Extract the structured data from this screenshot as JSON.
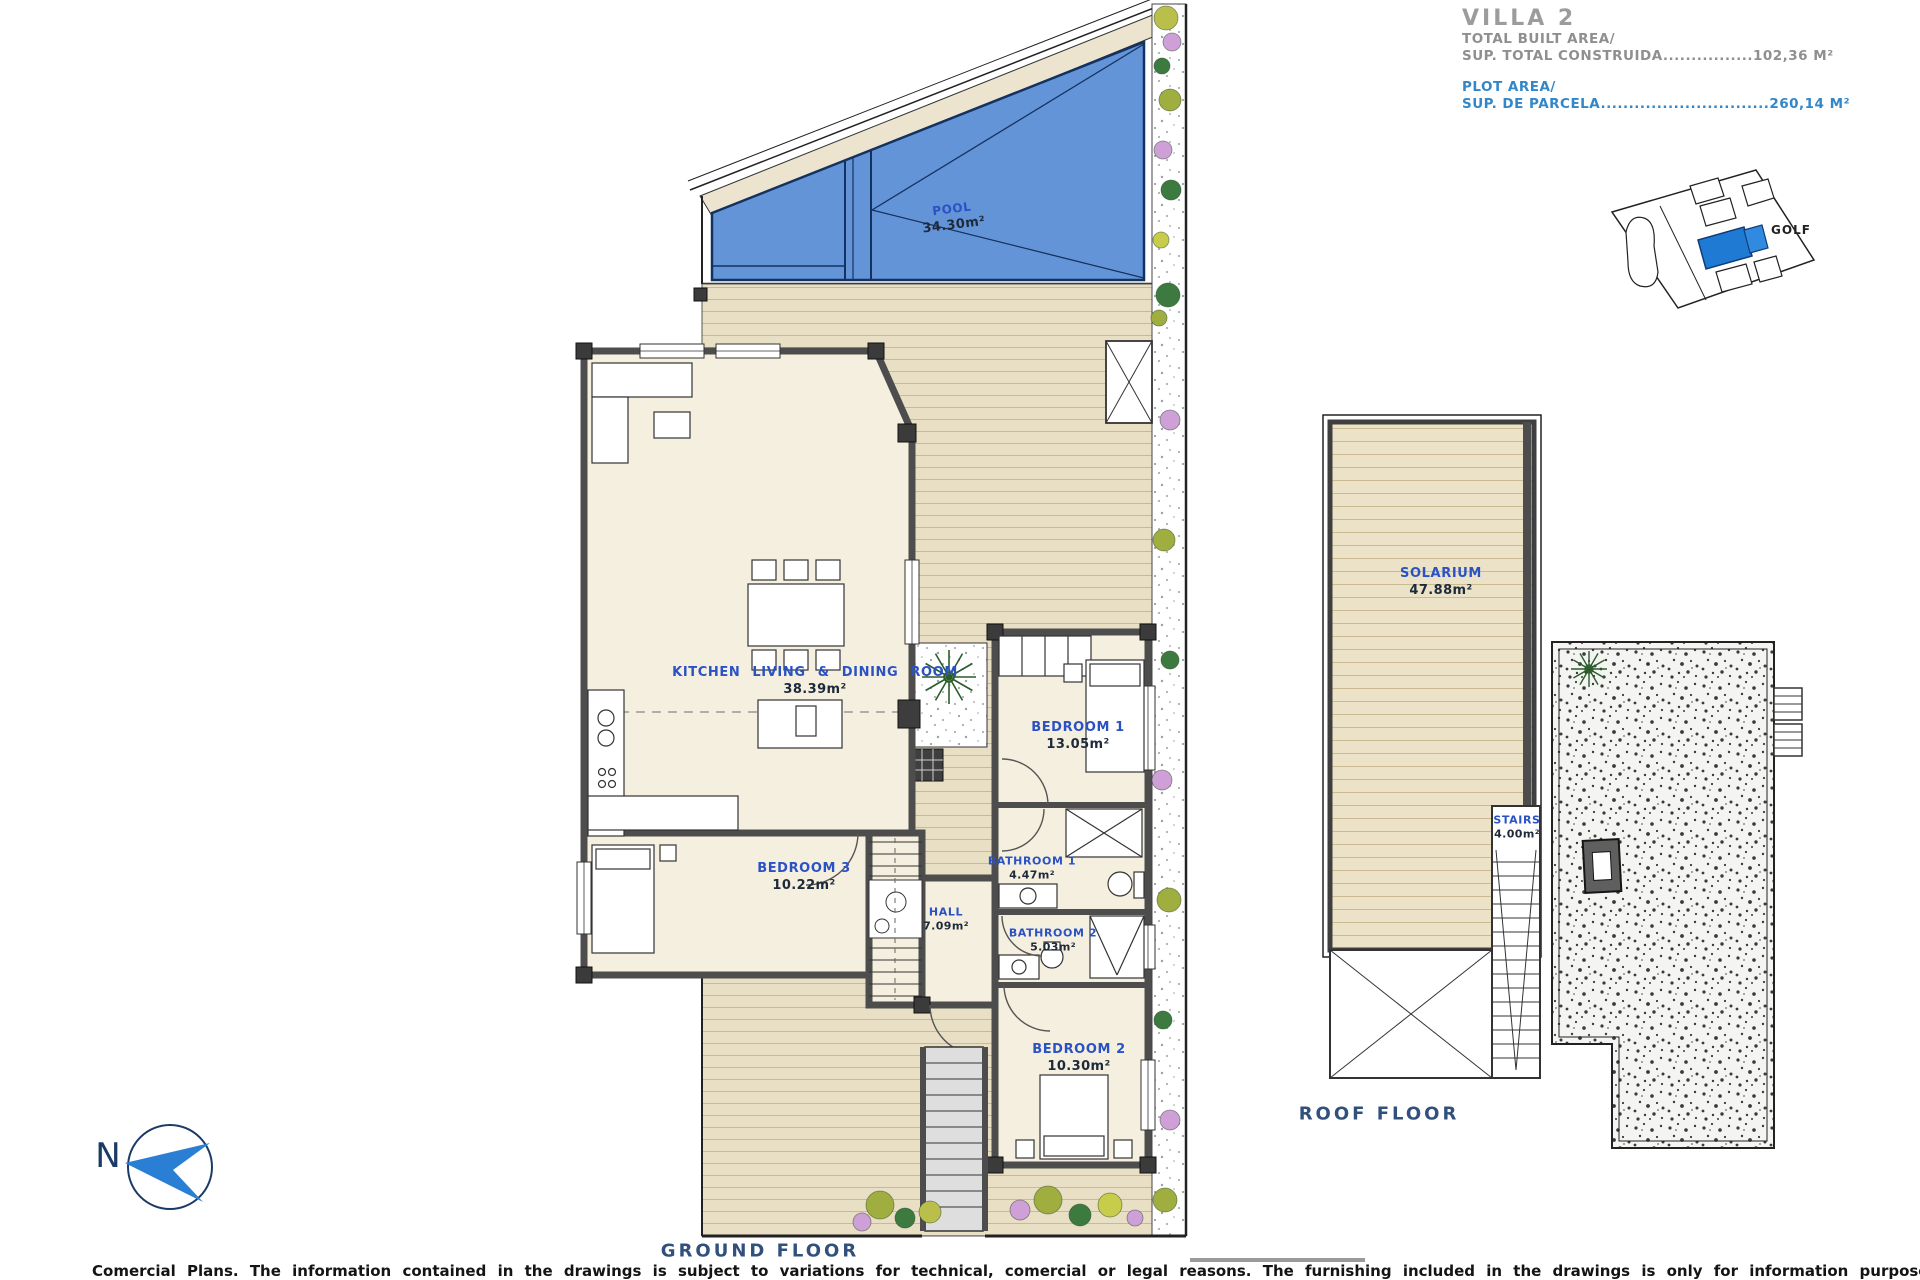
{
  "title_block": {
    "villa": "VILLA 2",
    "built_area_label": "TOTAL BUILT AREA/",
    "built_area_value_line": "SUP. TOTAL CONSTRUIDA................102,36 M²",
    "plot_area_label": "PLOT AREA/",
    "plot_area_value_line": "SUP. DE PARCELA..............................260,14 M²"
  },
  "site_map": {
    "golf_label": "GOLF",
    "highlight_color": "#1f7ad4"
  },
  "ground_floor": {
    "caption": "GROUND FLOOR",
    "pool": {
      "name": "POOL",
      "area": "34.30m²"
    },
    "rooms": {
      "kitchen": {
        "name": "KITCHEN LIVING & DINING ROOM",
        "area": "38.39m²"
      },
      "bedroom1": {
        "name": "BEDROOM 1",
        "area": "13.05m²"
      },
      "bedroom2": {
        "name": "BEDROOM 2",
        "area": "10.30m²"
      },
      "bedroom3": {
        "name": "BEDROOM 3",
        "area": "10.22m²"
      },
      "bathroom1": {
        "name": "BATHROOM 1",
        "area": "4.47m²"
      },
      "bathroom2": {
        "name": "BATHROOM 2",
        "area": "5.03m²"
      },
      "hall": {
        "name": "HALL",
        "area": "7.09m²"
      }
    }
  },
  "roof_floor": {
    "caption": "ROOF FLOOR",
    "rooms": {
      "solarium": {
        "name": "SOLARIUM",
        "area": "47.88m²"
      },
      "stairs": {
        "name": "STAIRS",
        "area": "4.00m²"
      }
    }
  },
  "north_indicator": {
    "letter": "N",
    "arrow_color": "#2a7fd4"
  },
  "footer": {
    "disclaimer": "Comercial Plans. The information contained in the drawings is subject to variations for technical, comercial or legal reasons. The furnishing included in the drawings is only for information purposes."
  },
  "colors": {
    "pool_blue": "#6394d8",
    "pool_line": "#16305e",
    "deck_tan": "#e8dfc4",
    "room_fill": "#f5efdf",
    "wall_gray": "#4d4d4d",
    "label_blue": "#2a52c4",
    "caption_navy": "#31507c",
    "title_gray": "#9c9c9c",
    "title_blue": "#3187c9"
  }
}
